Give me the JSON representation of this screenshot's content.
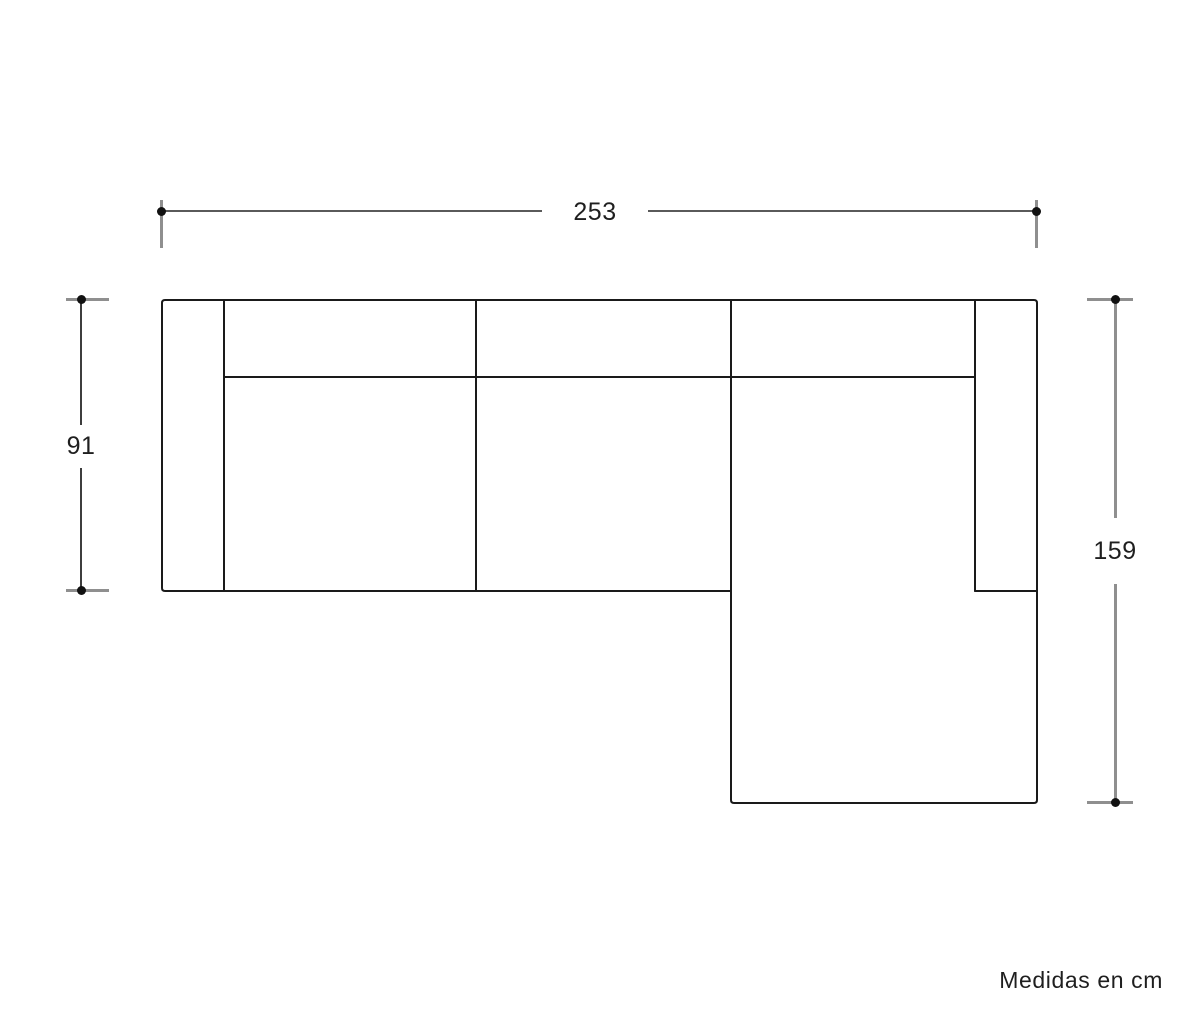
{
  "diagram": {
    "subject": "sofa-chaise-top-view",
    "dimensions": {
      "total_width_cm": "253",
      "body_depth_cm": "91",
      "chaise_depth_cm": "159"
    },
    "note": "Medidas en cm"
  },
  "colors": {
    "outline": "#1a1a1a",
    "dimension_line": "#5a5a5a",
    "dimension_line_thick": "#8f8f8f",
    "dimension_tick": "#8f8f8f",
    "dimension_dot": "#111111",
    "label_text": "#1f1f1f",
    "background": "#ffffff"
  }
}
